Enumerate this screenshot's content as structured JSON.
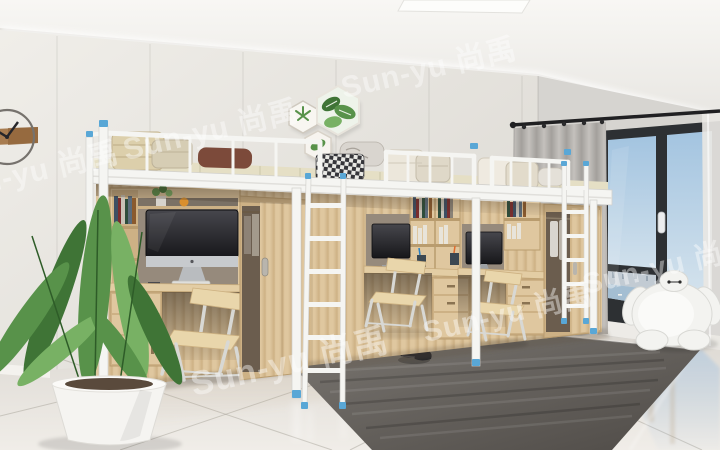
{
  "watermark": {
    "text": "Sun-yu 尚禹",
    "color": "#ffffff",
    "opacity": 0.42
  },
  "palette": {
    "ceilingLight": "#f8f7f4",
    "ceilingDark": "#e8e6e2",
    "coveWhite": "#ffffff",
    "wallLeftLight": "#f0eee9",
    "wallLeftDark": "#d9d6d0",
    "wallRight": "#d6d4d0",
    "floorLight": "#f0ede8",
    "floorDark": "#dcd8d2",
    "baseboard": "#f4f2ee",
    "rugLight": "#7a7671",
    "rugDark": "#4f4b47",
    "woodLight": "#dfc79f",
    "woodDark": "#cdb185",
    "woodEdge": "#b99c6e",
    "frameWhite": "#f5f5f2",
    "frameShadow": "#d2d1cd",
    "accentBlue": "#59a7d6",
    "windowFrame": "#2d3033",
    "skyTop": "#a3c4e0",
    "skyBottom": "#dde8ef",
    "cityGray": "#c2cbd3",
    "waterBlue": "#a4bed2",
    "curtainLight": "#c4c1bd",
    "curtainDark": "#a3a09c",
    "sheer": "#e9e7e3",
    "leafDark": "#3f7436",
    "leafMid": "#58924a",
    "leafLight": "#78b164",
    "pot": "#f5f4f1",
    "screenDark": "#17171a",
    "screenLight": "#47474d",
    "bezel": "#c7cacd",
    "quilt": "#dccfab",
    "pillowBrown": "#7c4a3a",
    "mattress": "#e5dfc5",
    "checkDark": "#35353a",
    "shoe": "#232327",
    "nicheShadow": "#968a7c",
    "interiorDark": "#6b5d4e",
    "baymax": "#f3f3f0",
    "clothes": "#d9d5cf",
    "plywood": "#e9d6ab",
    "legSilver": "#d8d8d4"
  },
  "scene_objects": [
    "wall-clock",
    "hexagon-wall-art",
    "ceiling-light-panel",
    "cove-light",
    "loft-bed-1",
    "loft-bed-2",
    "loft-bed-3",
    "bedding-quilts",
    "pillows",
    "desk-computer-1",
    "desk-computer-2",
    "desk-computer-3",
    "desk-chair-1",
    "desk-chair-2",
    "desk-chair-3",
    "bookshelves",
    "wardrobe-1",
    "wardrobe-2",
    "wardrobe-3",
    "ladder-1",
    "ladder-2",
    "potted-plant",
    "area-rug",
    "black-shoes",
    "baymax-plush",
    "gray-curtain",
    "sheer-curtain",
    "balcony-glass-door",
    "marble-floor"
  ]
}
